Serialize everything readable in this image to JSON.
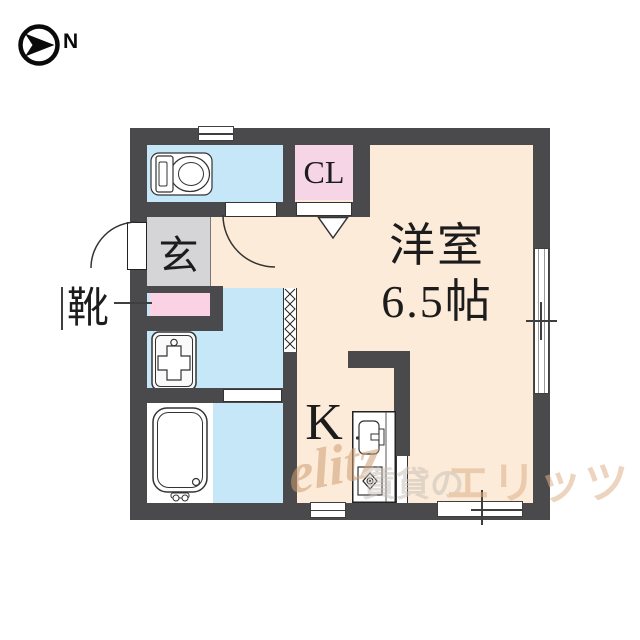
{
  "compass": {
    "direction_label": "N",
    "icon": "compass-north-icon"
  },
  "plan": {
    "closet_label": "CL",
    "entrance_label": "玄",
    "shoes_label": "靴",
    "kitchen_label": "K",
    "room_name": "洋室",
    "room_size": "6.5帖",
    "watermark": {
      "logo": "elitz",
      "text_prefix": "賃貸の",
      "text_brand": "エリッツ"
    }
  },
  "colors": {
    "wall": "#4a4a4c",
    "flooring_cream": "#fdebd9",
    "wet_area_blue": "#c6e7f8",
    "closet_pink": "#f6d5e7",
    "shoebox_pink": "#fad2e4",
    "entrance_gray": "#d5d5d7",
    "watermark_tan": "#ddb18a"
  },
  "icons": [
    "compass-north-icon",
    "toilet-icon",
    "washing-machine-pan-icon",
    "bathtub-icon",
    "kitchen-sink-stove-icon",
    "door-swing-arc-icon",
    "folding-door-zigzag-icon",
    "door-swing-triangle-icon",
    "window-symbol"
  ]
}
